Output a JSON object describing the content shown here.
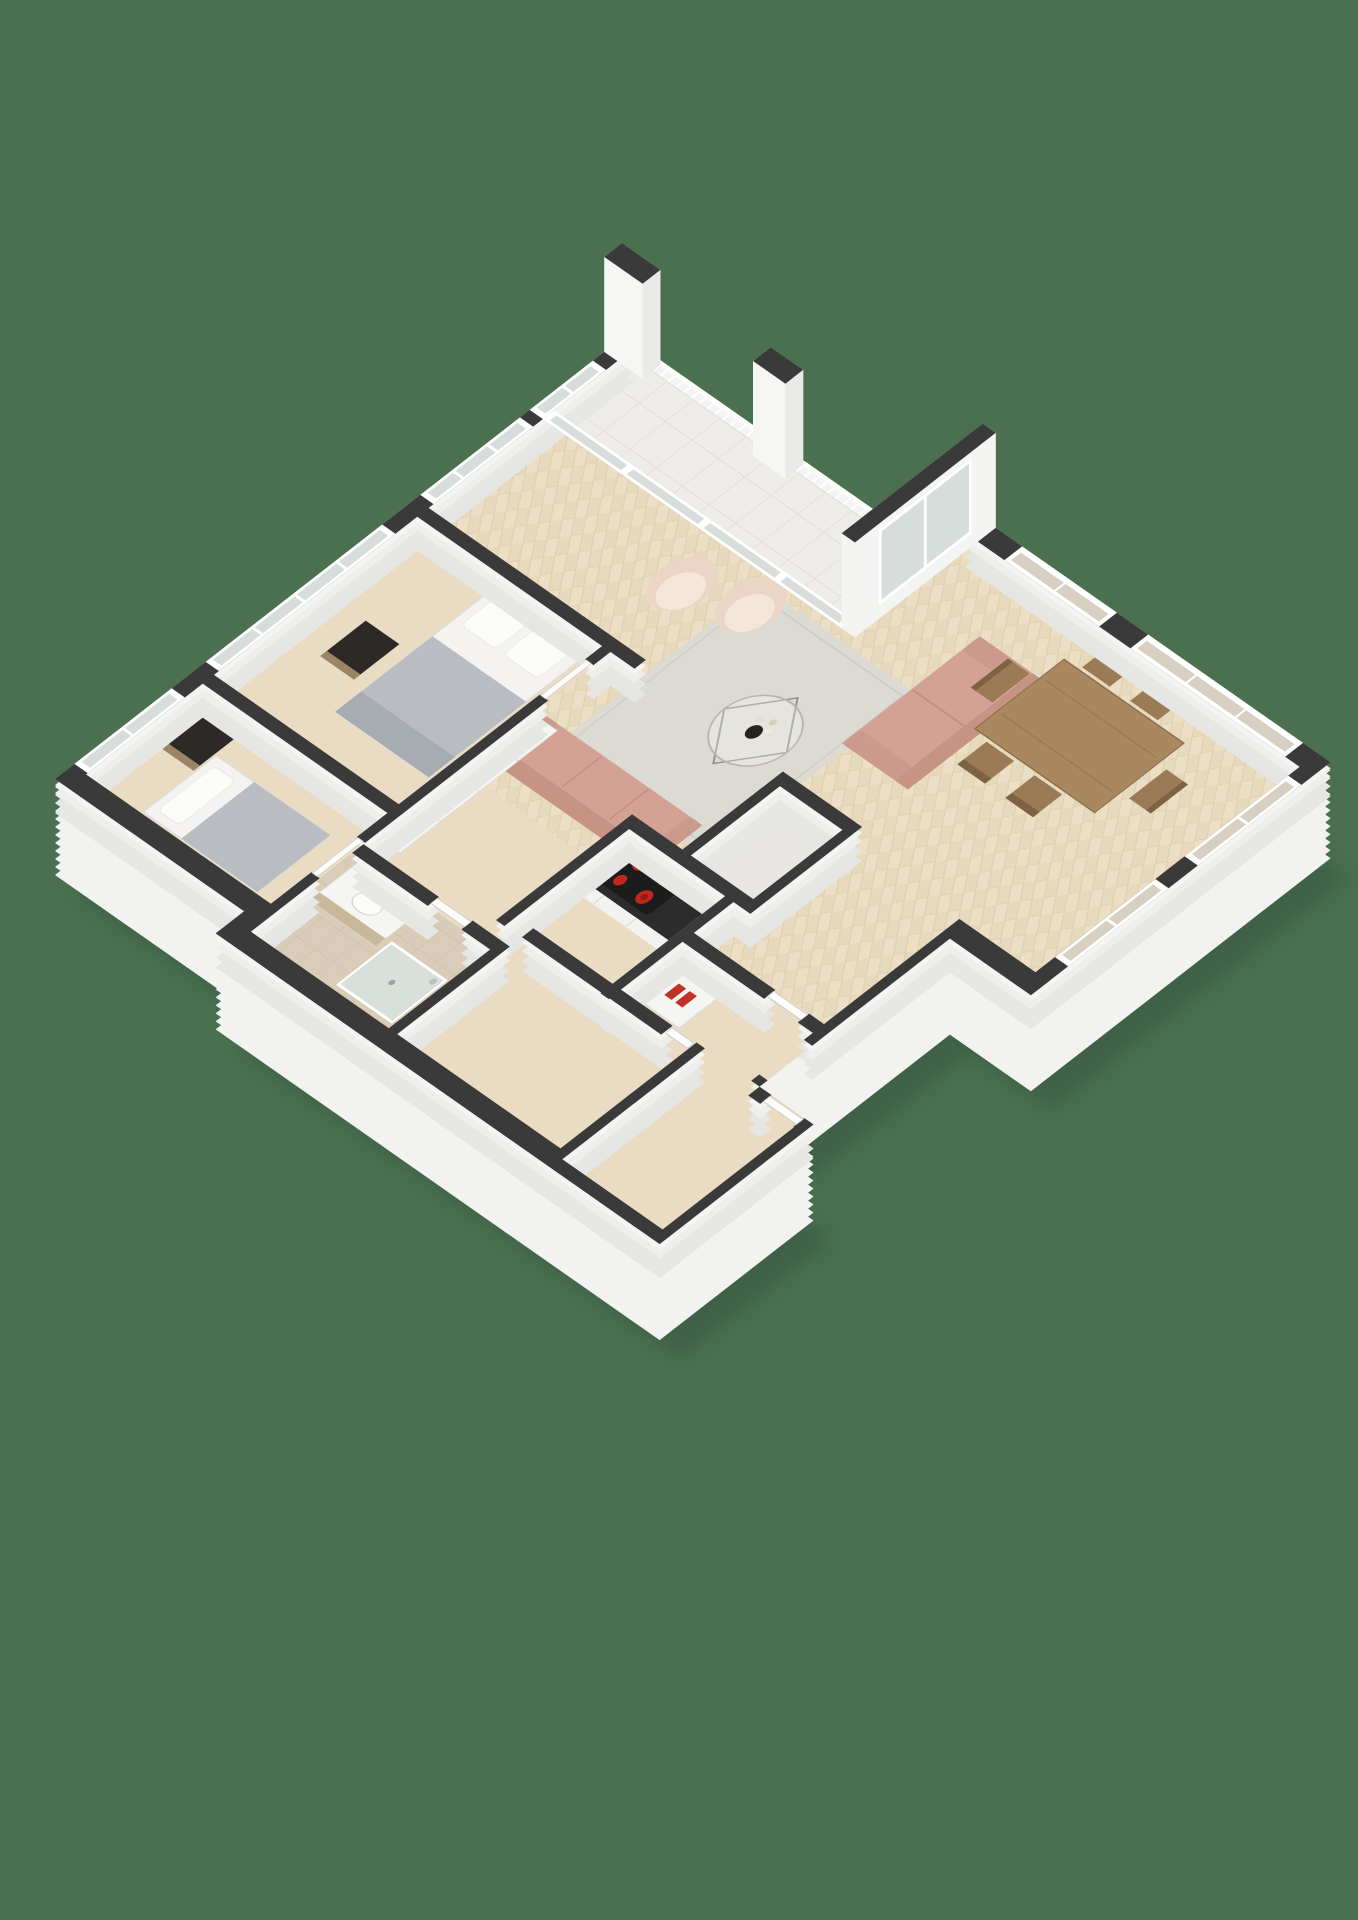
{
  "page": {
    "title": "Apartment 3D floor plan — isometric render"
  },
  "colors": {
    "background": "#4a7050",
    "shadow": "#35523d",
    "wall_top": "#3a3a3a",
    "wall_face": "#f2f2f1",
    "wall_side": "#e6e6e4",
    "floor_wood": "#e9dcc3",
    "plank": "#ddcbaa",
    "balcony_tile": "#edece8",
    "bathroom_tile": "#d9cdb9",
    "wc_tile": "#e8e7e3",
    "rug": "#dcdbd3",
    "sofa": "#d4a294",
    "sofa_back": "#c69385",
    "armchair": "#ebd5c6",
    "armchair_inner": "#f4e7da",
    "dining_wood": "#a9875f",
    "chair_wood": "#9b7b55",
    "chair_back": "#7e6243",
    "bed_linen": "#f4f3f1",
    "bed_blanket": "#b9bdc2",
    "bed_throw": "#a7acb2",
    "nightstand": "#2d2926",
    "nightstand_base": "#9c8565",
    "counter_top": "#2c2c2c",
    "stove_pad": "#1c1c1c",
    "stove_burner": "#c1271b",
    "glass": "#d7dddb",
    "glass_curtain": "#d6cfc2",
    "railing": "#f4f4f4",
    "shower_glass": "#d8e2e0",
    "vanity_wood": "#c9b79b",
    "shoe_red": "#c23126"
  },
  "scene": {
    "type": "isometric-3d-floor-plan",
    "background": "solid green",
    "rooms": [
      {
        "name": "living-room",
        "floor": "herringbone wood",
        "items": [
          "rug",
          "sofa",
          "loveseat",
          "armchair x2",
          "glass coffee table with vase"
        ]
      },
      {
        "name": "dining-area",
        "floor": "herringbone wood",
        "items": [
          "dining table",
          "dining chair x6"
        ]
      },
      {
        "name": "kitchen-nook",
        "items": [
          "counter",
          "cooktop with 4 red burners"
        ]
      },
      {
        "name": "master-bedroom",
        "items": [
          "double bed",
          "nightstand"
        ]
      },
      {
        "name": "second-bedroom",
        "items": [
          "single bed",
          "nightstand"
        ]
      },
      {
        "name": "bathroom",
        "floor": "beige tile",
        "items": [
          "vanity sink",
          "walk-in shower"
        ]
      },
      {
        "name": "hallway",
        "items": [
          "wardrobe closets",
          "shoe console with red shoes"
        ]
      },
      {
        "name": "entry"
      },
      {
        "name": "utility-room"
      },
      {
        "name": "wc"
      },
      {
        "name": "balcony",
        "floor": "light tile",
        "items": [
          "railing x2 sections",
          "tall wall pillars x3"
        ]
      }
    ],
    "counts": {
      "balcony_railing_sections": 2,
      "tall_pillars": 3,
      "dining_chairs": 6,
      "armchairs": 2,
      "sofas": 2,
      "beds": 2,
      "cooktop_burners": 4,
      "window_bays_nw": 4,
      "window_bays_ne": 2,
      "window_bays_se": 2
    }
  }
}
